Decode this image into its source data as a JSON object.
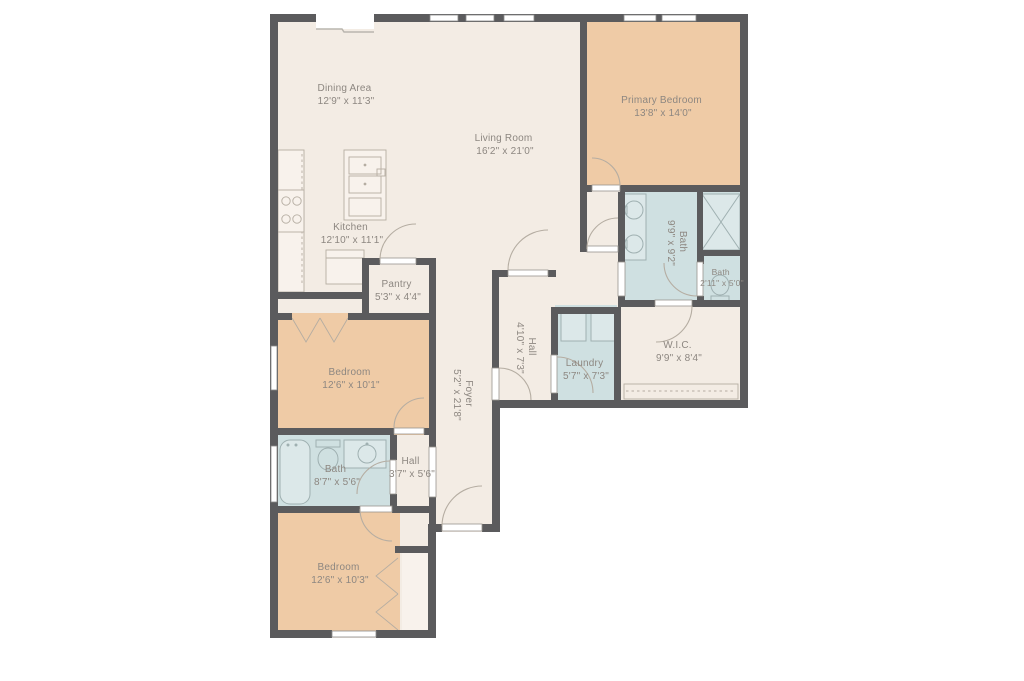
{
  "colors": {
    "wall": "#5b5b5d",
    "floor": "#f3ece4",
    "floor_light": "#f8f2ec",
    "bedroom": "#efcba6",
    "bath": "#cfe0e1",
    "fixture_fill": "#dce8e9",
    "fixture_line": "#9fb0b1",
    "line": "#b5ada2",
    "text": "#8d8781"
  },
  "rooms": {
    "dining": {
      "name": "Dining Area",
      "dims": "12'9\" x 11'3\""
    },
    "living": {
      "name": "Living Room",
      "dims": "16'2\" x 21'0\""
    },
    "kitchen": {
      "name": "Kitchen",
      "dims": "12'10\" x 11'1\""
    },
    "pantry": {
      "name": "Pantry",
      "dims": "5'3\" x 4'4\""
    },
    "primary_bedroom": {
      "name": "Primary Bedroom",
      "dims": "13'8\" x 14'0\""
    },
    "primary_bath": {
      "name": "Bath",
      "dims": "9'9\" x 9'2\""
    },
    "water_closet": {
      "name": "Bath",
      "dims": "2'11\" x 5'0\""
    },
    "wic": {
      "name": "W.I.C.",
      "dims": "9'9\" x 8'4\""
    },
    "laundry": {
      "name": "Laundry",
      "dims": "5'7\" x 7'3\""
    },
    "hall_upper": {
      "name": "Hall",
      "dims": "4'10\" x 7'3\""
    },
    "foyer": {
      "name": "Foyer",
      "dims": "5'2\" x 21'8\""
    },
    "bedroom_mid": {
      "name": "Bedroom",
      "dims": "12'6\" x 10'1\""
    },
    "bath_hall": {
      "name": "Bath",
      "dims": "8'7\" x 5'6\""
    },
    "hall_lower": {
      "name": "Hall",
      "dims": "3'7\" x 5'6\""
    },
    "bedroom_lower": {
      "name": "Bedroom",
      "dims": "12'6\" x 10'3\""
    }
  },
  "fixtures": [
    "range-burners",
    "kitchen-island-sink",
    "counter",
    "refrigerator",
    "double-vanity-sinks",
    "shower",
    "toilet",
    "bathtub",
    "vanity-sink",
    "washer",
    "dryer",
    "closet-rod",
    "bifold-closet-doors"
  ]
}
